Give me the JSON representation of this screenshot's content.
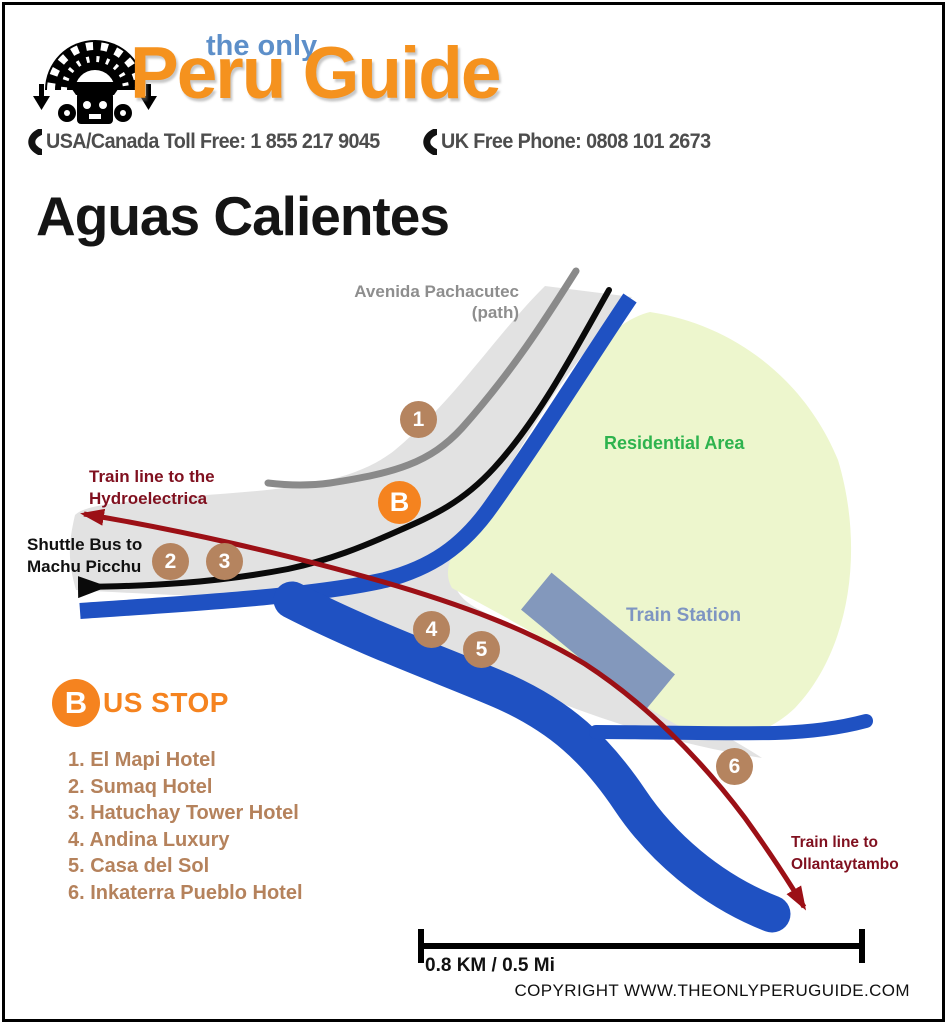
{
  "header": {
    "tagline": "the only",
    "brand": "Peru Guide",
    "phone_usa": "USA/Canada Toll Free: 1 855 217 9045",
    "phone_uk": "UK Free Phone: 0808 101 2673"
  },
  "page_title": "Aguas Calientes",
  "map": {
    "labels": {
      "avenida_line1": "Avenida Pachacutec",
      "avenida_line2": "(path)",
      "residential": "Residential Area",
      "train_station": "Train Station",
      "hydro_line1": "Train line to the",
      "hydro_line2": "Hydroelectrica",
      "shuttle_line1": "Shuttle Bus to",
      "shuttle_line2": "Machu Picchu",
      "ollanta_line1": "Train line to",
      "ollanta_line2": "Ollantaytambo"
    },
    "markers": {
      "m1": "1",
      "m2": "2",
      "m3": "3",
      "m4": "4",
      "m5": "5",
      "m6": "6",
      "bus": "B"
    }
  },
  "legend": {
    "bus_badge": "B",
    "bus_label": "US STOP",
    "hotels": [
      "1. El Mapi Hotel",
      "2. Sumaq Hotel",
      "3. Hatuchay Tower Hotel",
      "4. Andina Luxury",
      "5. Casa del Sol",
      "6. Inkaterra Pueblo Hotel"
    ]
  },
  "footer": {
    "scale_label": "0.8 KM / 0.5 Mi",
    "copyright": "COPYRIGHT WWW.THEONLYPERUGUIDE.COM"
  },
  "colors": {
    "orange": "#F5831F",
    "tagline_blue": "#5D8FC9",
    "river_blue": "#1F51C2",
    "residential_fill": "#EDF6CD",
    "residential_text": "#2EB34E",
    "station_blue": "#8398BC",
    "train_line_red": "#9C1016",
    "marker_brown": "#B5845F",
    "town_gray": "#E2E2E2"
  }
}
